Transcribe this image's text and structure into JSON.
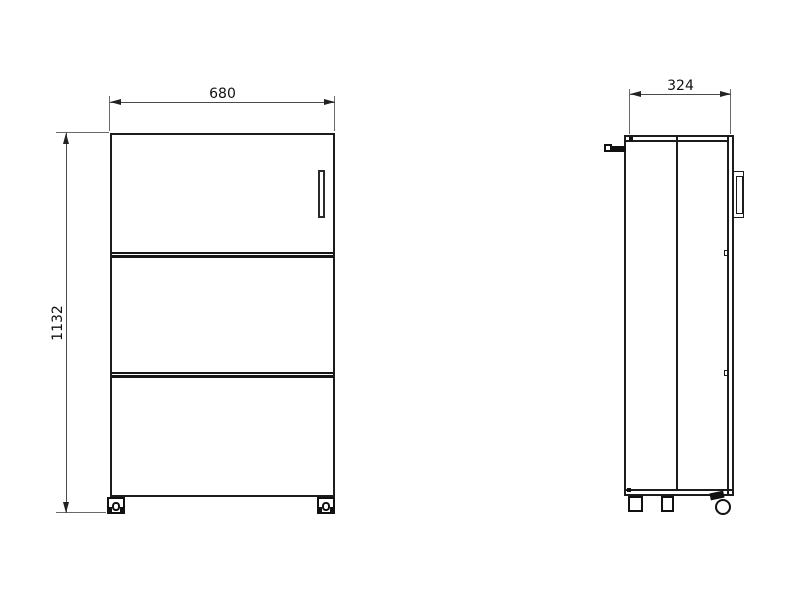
{
  "drawing": {
    "type": "technical-drawing",
    "background_color": "#ffffff",
    "object_line_color": "#1c1c1c",
    "dimension_line_color": "#4a4a4a",
    "dimensions": {
      "front_width": "680",
      "front_height": "1132",
      "side_depth": "324"
    },
    "views": {
      "front": {
        "sections": [
          "door-with-handle",
          "drawer",
          "drawer"
        ],
        "casters": 2
      },
      "side": {
        "features": [
          "top-handle",
          "rear-bracket-handle",
          "fixed-legs",
          "swivel-caster"
        ]
      }
    }
  }
}
